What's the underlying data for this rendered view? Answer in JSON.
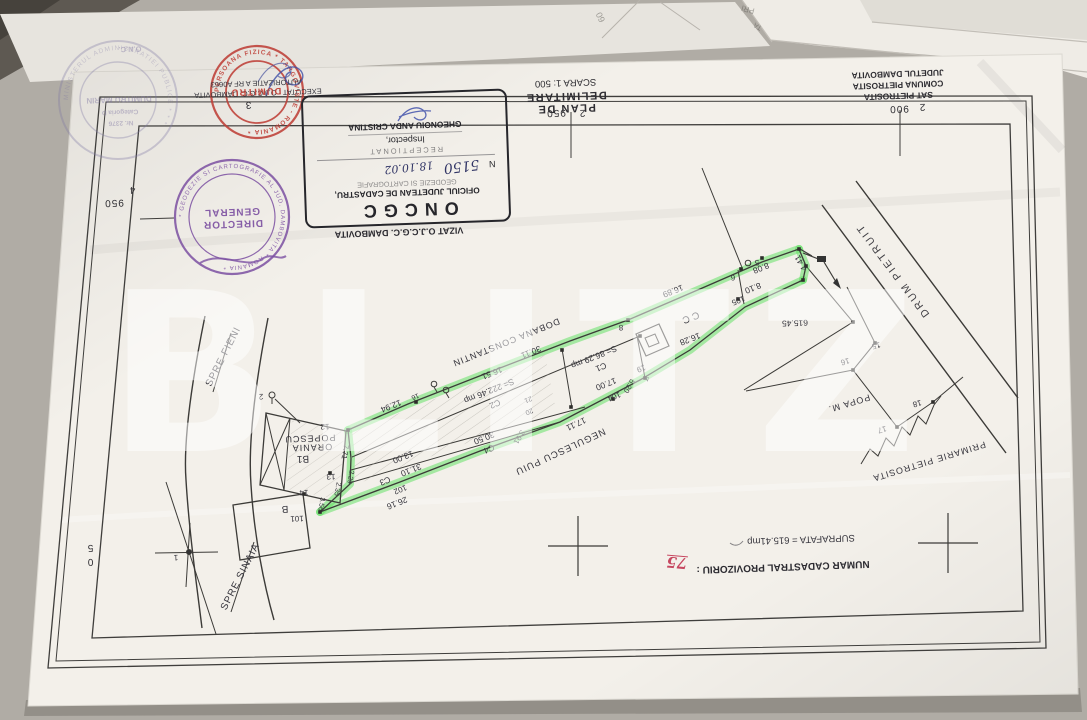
{
  "watermark": "BLITZ",
  "title_block": {
    "title": "PLAN DE DELIMITARE",
    "scale": "SCARA 1: 500",
    "location": [
      "SAT PIETROSITA",
      "COMUNA PIETROSITA",
      "JUDETUL DAMBOVITA"
    ]
  },
  "oncgc": {
    "title": "ONCGC",
    "line1": "OFICIUL JUDETEAN DE CADASTRU,",
    "line2": "GEODEZIE SI CARTOGRAFIE",
    "nr_prefix": "N",
    "nr_value": "5150",
    "date": "18.10.02",
    "receptionat": "RECEPTIONAT",
    "inspector_label": "Inspector,",
    "inspector_name": "GHEONOIU ANDA CRISTINA"
  },
  "stamps": {
    "purple_ring": "* GEODEZIE SI CARTOGRAFIE AL JUD. DAMBOVITA * ROMANIA *",
    "red_ring": "PERSOANA FIZICA * TARGOVISTE - ROMANIA *",
    "faded_ring": "MINISTERUL ADMINISTRATIEI PUBLICE * * *"
  },
  "plan_labels": [
    {
      "t": "950",
      "x": 556,
      "y": 112,
      "r": 178,
      "s": 10,
      "c": "grid",
      "g": "grid-coordinate"
    },
    {
      "t": "2",
      "x": 582,
      "y": 112,
      "r": 178,
      "s": 10,
      "c": "grid",
      "g": "grid-coordinate"
    },
    {
      "t": "900",
      "x": 899,
      "y": 108,
      "r": 178,
      "s": 10,
      "c": "grid",
      "g": "grid-coordinate"
    },
    {
      "t": "2",
      "x": 922,
      "y": 106,
      "r": 178,
      "s": 10,
      "c": "grid",
      "g": "grid-coordinate"
    },
    {
      "t": "950",
      "x": 114,
      "y": 202,
      "r": 178,
      "s": 10,
      "c": "grid",
      "g": "grid-coordinate"
    },
    {
      "t": "4",
      "x": 132,
      "y": 189,
      "r": 178,
      "s": 10,
      "c": "grid",
      "g": "grid-coordinate"
    },
    {
      "t": "3",
      "x": 248,
      "y": 104,
      "r": 178,
      "s": 10,
      "c": "grid",
      "g": "grid-coordinate"
    },
    {
      "t": "5",
      "x": 90,
      "y": 547,
      "r": 178,
      "s": 10,
      "c": "grid",
      "g": "grid-coordinate"
    },
    {
      "t": "0",
      "x": 90,
      "y": 561,
      "r": 178,
      "s": 10,
      "c": "grid",
      "g": "grid-coordinate"
    },
    {
      "t": "16.89",
      "x": 673,
      "y": 291,
      "r": 158,
      "c": "m",
      "g": "measurement"
    },
    {
      "t": "8.08",
      "x": 761,
      "y": 268,
      "r": 158,
      "c": "m",
      "g": "measurement"
    },
    {
      "t": "8.10",
      "x": 753,
      "y": 288,
      "r": 158,
      "c": "m",
      "g": "measurement"
    },
    {
      "t": "4.41",
      "x": 801,
      "y": 263,
      "r": 240,
      "c": "m",
      "g": "measurement"
    },
    {
      "t": "16.28",
      "x": 690,
      "y": 339,
      "r": 158,
      "c": "m",
      "g": "measurement"
    },
    {
      "t": "30.11",
      "x": 531,
      "y": 352,
      "r": 158,
      "c": "m",
      "g": "measurement"
    },
    {
      "t": "16.51",
      "x": 492,
      "y": 373,
      "r": 158,
      "c": "m",
      "g": "measurement"
    },
    {
      "t": "12.94",
      "x": 391,
      "y": 406,
      "r": 158,
      "c": "m",
      "g": "measurement"
    },
    {
      "t": "13.00",
      "x": 403,
      "y": 457,
      "r": 158,
      "c": "m",
      "g": "measurement"
    },
    {
      "t": "31.10",
      "x": 411,
      "y": 470,
      "r": 158,
      "c": "m",
      "g": "measurement"
    },
    {
      "t": "26.16",
      "x": 397,
      "y": 503,
      "r": 158,
      "c": "m",
      "g": "measurement"
    },
    {
      "t": "30.50",
      "x": 484,
      "y": 438,
      "r": 158,
      "c": "m",
      "g": "measurement"
    },
    {
      "t": "17.00",
      "x": 606,
      "y": 384,
      "r": 158,
      "c": "m",
      "g": "measurement"
    },
    {
      "t": "5.20",
      "x": 629,
      "y": 386,
      "r": 120,
      "s": 7.5,
      "c": "m",
      "g": "measurement"
    },
    {
      "t": "17.11",
      "x": 576,
      "y": 424,
      "r": 155,
      "c": "m",
      "g": "measurement"
    },
    {
      "t": "3.91",
      "x": 519,
      "y": 437,
      "r": 120,
      "s": 7.5,
      "c": "m",
      "g": "measurement"
    },
    {
      "t": "7.71",
      "x": 345,
      "y": 452,
      "r": 100,
      "s": 7.5,
      "c": "m",
      "g": "measurement"
    },
    {
      "t": "2.29",
      "x": 350,
      "y": 477,
      "r": 100,
      "s": 7,
      "c": "m",
      "g": "measurement"
    },
    {
      "t": "2.35",
      "x": 337,
      "y": 489,
      "r": 100,
      "s": 7,
      "c": "m",
      "g": "measurement"
    },
    {
      "t": "3.56",
      "x": 321,
      "y": 504,
      "r": 100,
      "s": 7,
      "c": "m",
      "g": "measurement"
    },
    {
      "t": "615.45",
      "x": 795,
      "y": 323,
      "r": 178,
      "c": "m",
      "g": "measurement"
    },
    {
      "t": "105",
      "x": 738,
      "y": 300,
      "r": 158,
      "s": 8,
      "c": "pt",
      "g": "point-id"
    },
    {
      "t": "104",
      "x": 614,
      "y": 396,
      "r": 158,
      "s": 8,
      "c": "pt",
      "g": "point-id"
    },
    {
      "t": "102",
      "x": 400,
      "y": 489,
      "r": 158,
      "s": 8,
      "c": "pt",
      "g": "point-id"
    },
    {
      "t": "101",
      "x": 297,
      "y": 518,
      "r": 178,
      "s": 8,
      "c": "pt",
      "g": "point-id"
    },
    {
      "t": "19",
      "x": 641,
      "y": 368,
      "r": 158,
      "s": 8,
      "c": "pt",
      "g": "point-id"
    },
    {
      "t": "20",
      "x": 529,
      "y": 411,
      "r": 158,
      "s": 7,
      "c": "pt",
      "g": "point-id"
    },
    {
      "t": "21",
      "x": 528,
      "y": 399,
      "r": 158,
      "s": 7,
      "c": "pt",
      "g": "point-id"
    },
    {
      "t": "4",
      "x": 647,
      "y": 378,
      "r": 158,
      "s": 7,
      "c": "pt",
      "g": "point-id"
    },
    {
      "t": "8",
      "x": 621,
      "y": 327,
      "r": 178,
      "s": 8,
      "c": "pt",
      "g": "point-id"
    },
    {
      "t": "6",
      "x": 733,
      "y": 277,
      "r": 178,
      "s": 8,
      "c": "pt",
      "g": "point-id"
    },
    {
      "t": "5",
      "x": 757,
      "y": 262,
      "r": 178,
      "s": 8,
      "c": "pt",
      "g": "point-id"
    },
    {
      "t": "12",
      "x": 325,
      "y": 426,
      "r": 178,
      "s": 8,
      "c": "pt",
      "g": "point-id"
    },
    {
      "t": "13",
      "x": 331,
      "y": 476,
      "r": 178,
      "s": 8,
      "c": "pt",
      "g": "point-id"
    },
    {
      "t": "14",
      "x": 304,
      "y": 492,
      "r": 178,
      "s": 8,
      "c": "pt",
      "g": "point-id"
    },
    {
      "t": "16",
      "x": 415,
      "y": 396,
      "r": 158,
      "s": 7,
      "c": "pt",
      "g": "point-id"
    },
    {
      "t": "2",
      "x": 261,
      "y": 396,
      "r": 178,
      "s": 8,
      "c": "pt",
      "g": "point-id"
    },
    {
      "t": "1",
      "x": 176,
      "y": 557,
      "r": 178,
      "s": 8,
      "c": "pt",
      "g": "point-id"
    },
    {
      "t": "15",
      "x": 876,
      "y": 345,
      "r": 165,
      "s": 8,
      "c": "pt",
      "g": "point-id"
    },
    {
      "t": "16",
      "x": 845,
      "y": 361,
      "r": 165,
      "s": 8,
      "c": "pt",
      "g": "point-id"
    },
    {
      "t": "17",
      "x": 882,
      "y": 429,
      "r": 165,
      "s": 8,
      "c": "pt",
      "g": "point-id"
    },
    {
      "t": "18",
      "x": 917,
      "y": 403,
      "r": 165,
      "s": 8,
      "c": "pt",
      "g": "point-id"
    },
    {
      "t": "S= 86.29 mp",
      "x": 594,
      "y": 357,
      "r": 158,
      "c": "m",
      "g": "area-label"
    },
    {
      "t": "C1",
      "x": 601,
      "y": 367,
      "r": 158,
      "c": "m",
      "g": "building-id"
    },
    {
      "t": "S= 222.46 mp",
      "x": 489,
      "y": 391,
      "r": 158,
      "c": "m",
      "g": "area-label"
    },
    {
      "t": "C2",
      "x": 495,
      "y": 404,
      "r": 158,
      "c": "m",
      "g": "building-id"
    },
    {
      "t": "C3",
      "x": 385,
      "y": 481,
      "r": 158,
      "c": "m",
      "g": "building-id"
    },
    {
      "t": "C4",
      "x": 489,
      "y": 449,
      "r": 158,
      "c": "m",
      "g": "building-id"
    },
    {
      "t": "CC",
      "x": 689,
      "y": 317,
      "r": 158,
      "s": 10,
      "c": "zone",
      "g": "zone-label"
    },
    {
      "t": "B1",
      "x": 303,
      "y": 458,
      "r": 178,
      "s": 10,
      "c": "m",
      "g": "building-id"
    },
    {
      "t": "B",
      "x": 285,
      "y": 508,
      "r": 178,
      "s": 10,
      "c": "m",
      "g": "building-id"
    },
    {
      "t": "DOBANA CONSTANTIN",
      "x": 506,
      "y": 342,
      "r": 158,
      "s": 9,
      "c": "n",
      "g": "owner-name"
    },
    {
      "t": "NEGULESCU PUIU",
      "x": 560,
      "y": 451,
      "r": 155,
      "s": 9.5,
      "c": "n",
      "g": "owner-name"
    },
    {
      "t": "POPA M.",
      "x": 849,
      "y": 403,
      "r": 163,
      "s": 9,
      "c": "n",
      "g": "owner-name"
    },
    {
      "t": "PRIMARIE PIETROSITA",
      "x": 929,
      "y": 461,
      "r": 163,
      "s": 9,
      "c": "n",
      "g": "owner-name"
    },
    {
      "t": "POPESCU",
      "x": 310,
      "y": 438,
      "r": 178,
      "s": 9,
      "c": "n",
      "g": "owner-name"
    },
    {
      "t": "ORANIA",
      "x": 312,
      "y": 447,
      "r": 178,
      "s": 9,
      "c": "n",
      "g": "owner-name"
    },
    {
      "t": "DRUM PIETRUIT",
      "x": 893,
      "y": 270,
      "r": 233,
      "s": 10.5,
      "c": "road",
      "g": "road-name"
    },
    {
      "t": "SPRE FIENI",
      "x": 224,
      "y": 357,
      "r": -63,
      "s": 10,
      "c": "n",
      "g": "road-name"
    },
    {
      "t": "SPRE SINAIA",
      "x": 241,
      "y": 577,
      "r": -63,
      "s": 10,
      "c": "n",
      "g": "road-name"
    },
    {
      "t": "VIZAT O.J.C.G.C. DAMBOVITA",
      "x": 399,
      "y": 232,
      "r": 178,
      "s": 9,
      "c": "note-b",
      "g": "stamp-caption"
    },
    {
      "t": "EXECUTAT : O.J.C.G.C. DAMBOVITA",
      "x": 258,
      "y": 93,
      "r": 178,
      "s": 7.5,
      "c": "m",
      "g": "executor-note"
    },
    {
      "t": "AUTORIZATIE A RF A0663",
      "x": 256,
      "y": 83,
      "r": 178,
      "s": 7.5,
      "c": "m",
      "g": "executor-note"
    },
    {
      "t": "SUPRAFATA = 615.41mp",
      "x": 801,
      "y": 539,
      "r": 178,
      "s": 9.5,
      "c": "m",
      "g": "total-area"
    },
    {
      "t": "NUMAR CADASTRAL PROVIZORIU :",
      "x": 783,
      "y": 566,
      "r": 178,
      "s": 10,
      "c": "note-b",
      "g": "cadastral-number-label"
    },
    {
      "t": "75",
      "x": 677,
      "y": 562,
      "r": 185,
      "s": 15,
      "c": "red-hand",
      "g": "cadastral-number-value"
    },
    {
      "t": "DIRECTOR",
      "x": 233,
      "y": 223,
      "r": 178,
      "s": 10,
      "c": "stamp-purple",
      "g": "stamp-text"
    },
    {
      "t": "GENERAL",
      "x": 232,
      "y": 211,
      "r": 178,
      "s": 10,
      "c": "stamp-purple",
      "g": "stamp-text"
    },
    {
      "t": "DUMITRU",
      "x": 256,
      "y": 91,
      "r": 178,
      "s": 9.5,
      "c": "stamp-red",
      "g": "stamp-text"
    },
    {
      "t": "O.N.C.",
      "x": 130,
      "y": 49,
      "r": 178,
      "s": 7.5,
      "c": "stamp-faded",
      "g": "stamp-text"
    },
    {
      "t": "DUMITRU MARIN",
      "x": 119,
      "y": 99,
      "r": 178,
      "s": 8,
      "c": "stamp-faded",
      "g": "stamp-text"
    },
    {
      "t": "Categoria D",
      "x": 120,
      "y": 111,
      "r": 178,
      "s": 6.5,
      "c": "stamp-faded",
      "g": "stamp-text"
    },
    {
      "t": "Nr. 2376",
      "x": 121,
      "y": 122,
      "r": 178,
      "s": 6.5,
      "c": "stamp-faded",
      "g": "stamp-text"
    },
    {
      "t": "60",
      "x": 601,
      "y": 17,
      "r": 245,
      "s": 9,
      "c": "bg-frag",
      "g": "background-paper-text"
    },
    {
      "t": "PRI",
      "x": 748,
      "y": 9,
      "r": 195,
      "s": 8,
      "c": "bg-frag",
      "g": "background-paper-text"
    },
    {
      "t": "TA",
      "x": 758,
      "y": 26,
      "r": 210,
      "s": 7,
      "c": "bg-frag",
      "g": "background-paper-text"
    }
  ]
}
